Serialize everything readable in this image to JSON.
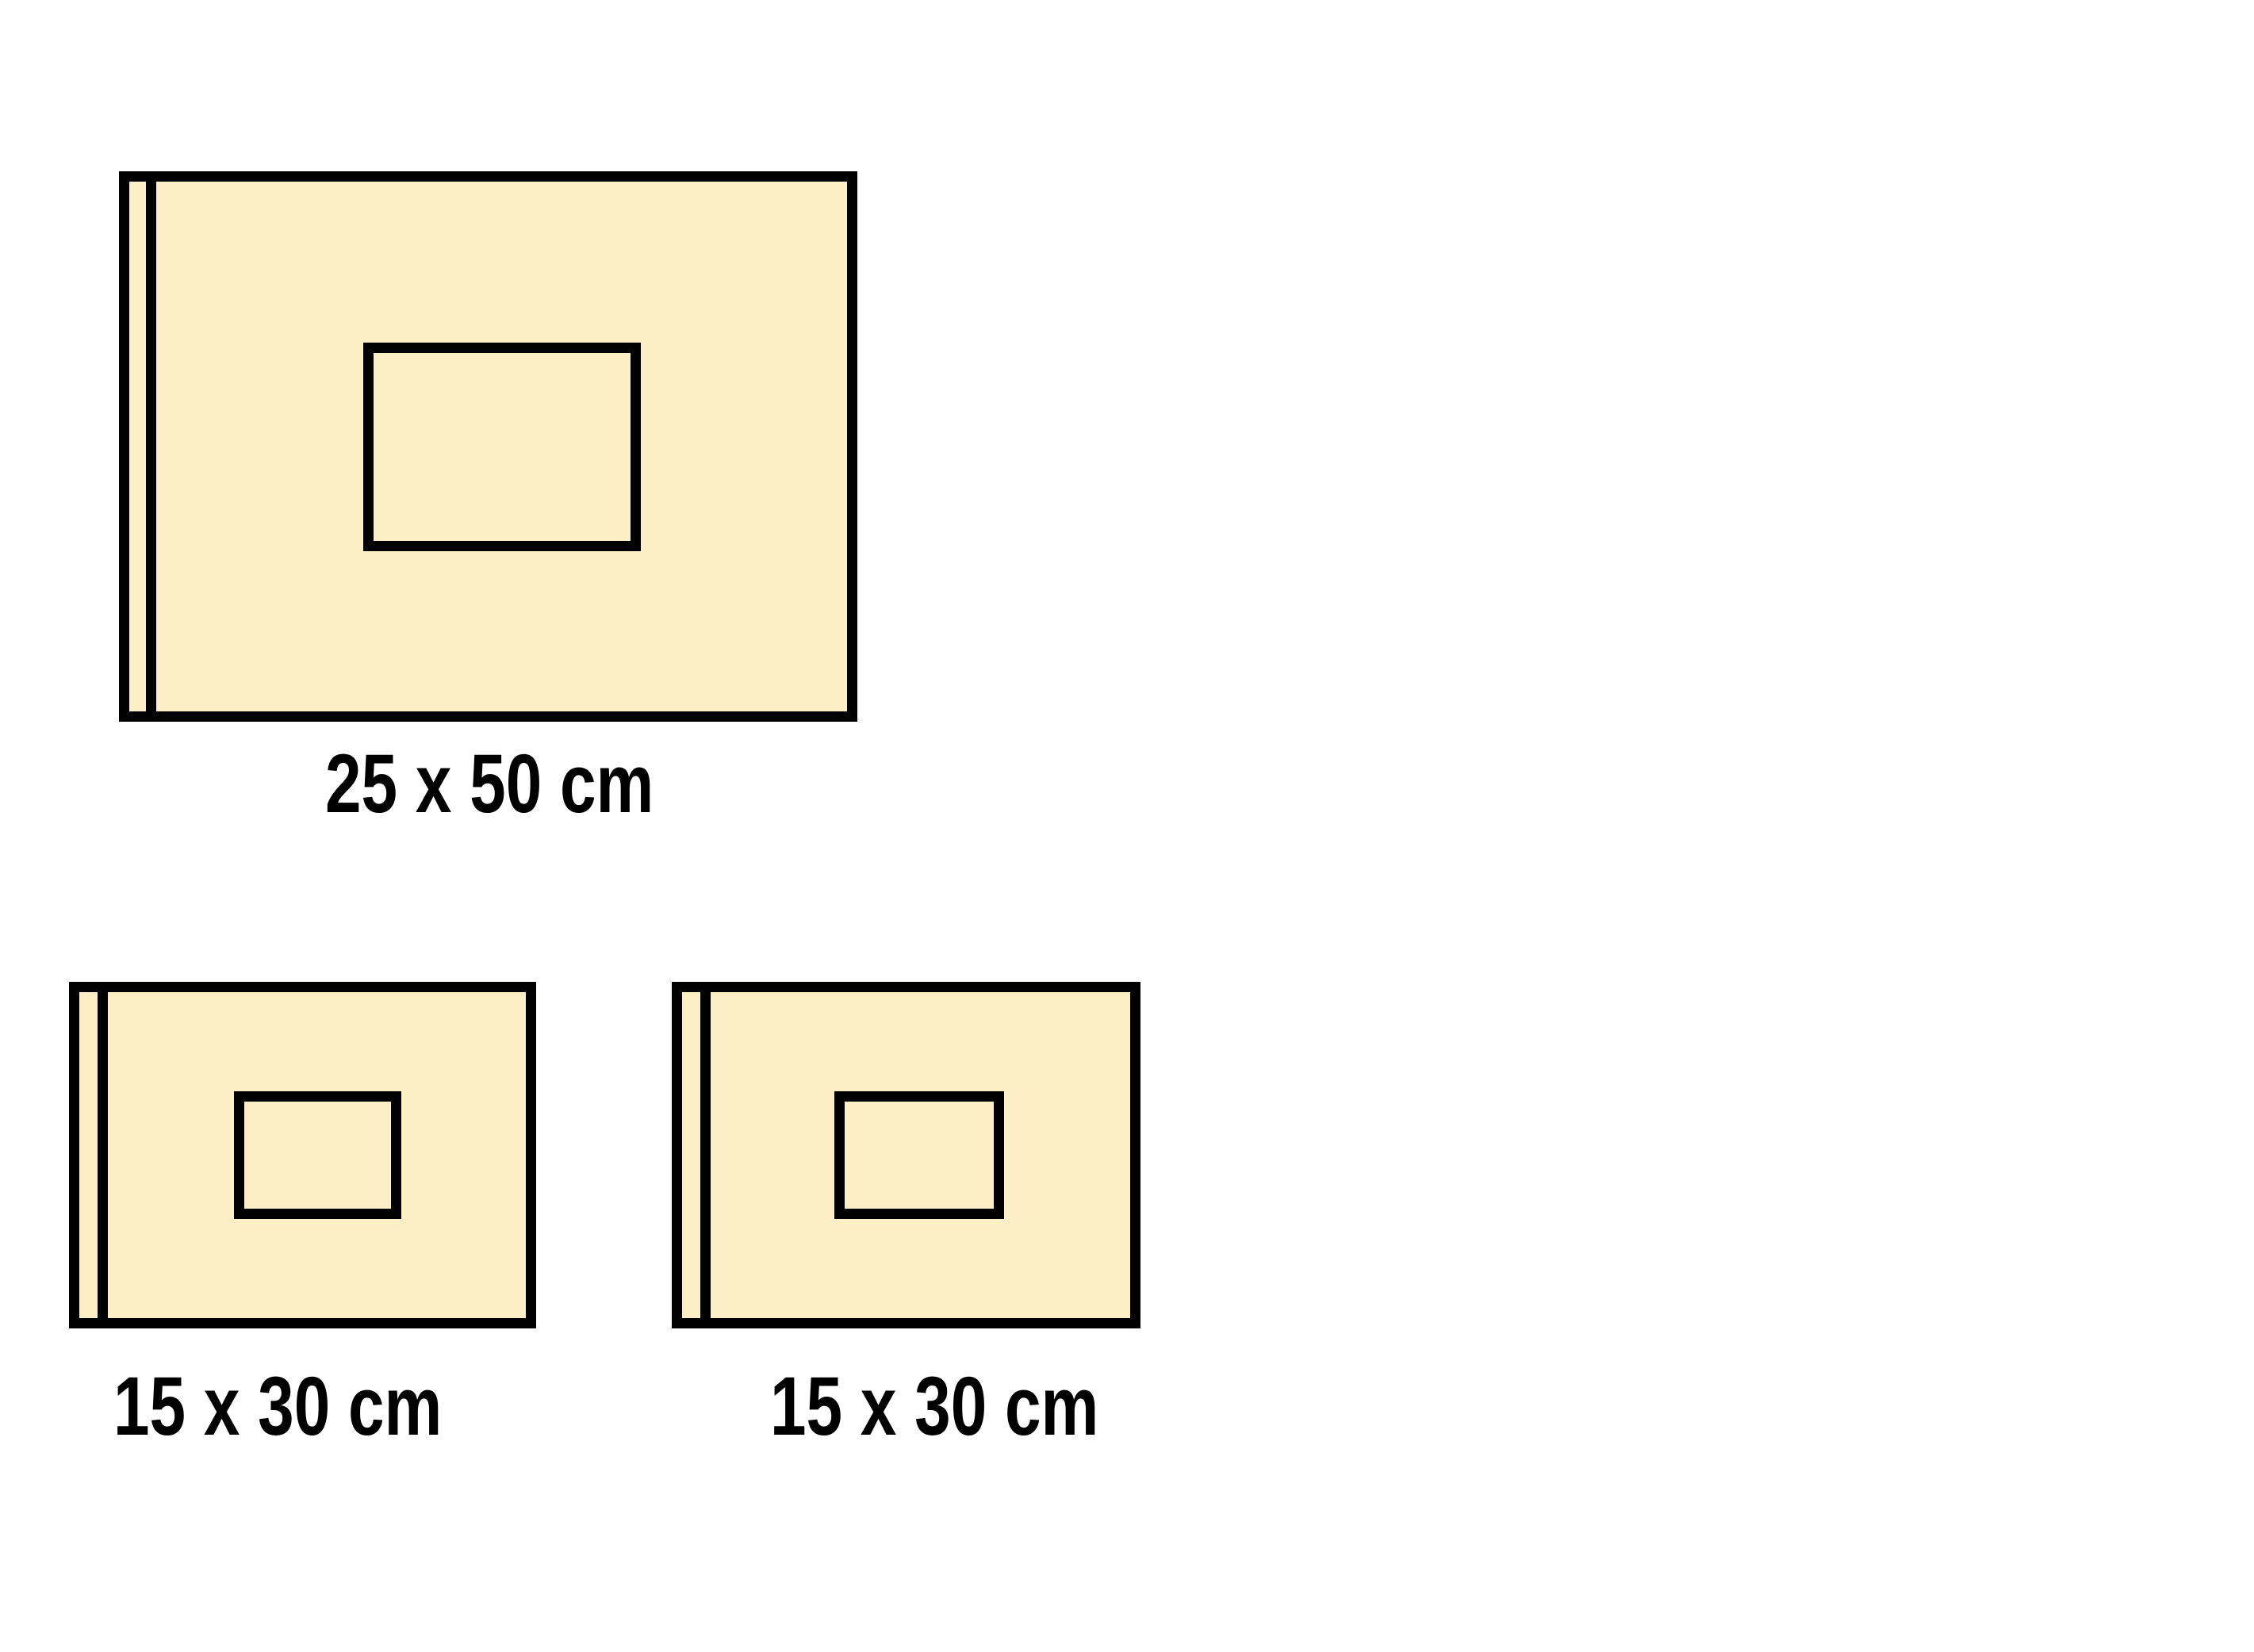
{
  "diagram": {
    "drapes": [
      {
        "id": "large-drape",
        "size_label": "25 x 50 cm"
      },
      {
        "id": "small-drape-1",
        "size_label": "15 x 30 cm"
      },
      {
        "id": "small-drape-2",
        "size_label": "15 x 30 cm"
      }
    ]
  },
  "colors": {
    "background": "#FFFFFF",
    "drape_fill": "#FCEEC5",
    "outline": "#000000",
    "label_text": "#000000"
  }
}
